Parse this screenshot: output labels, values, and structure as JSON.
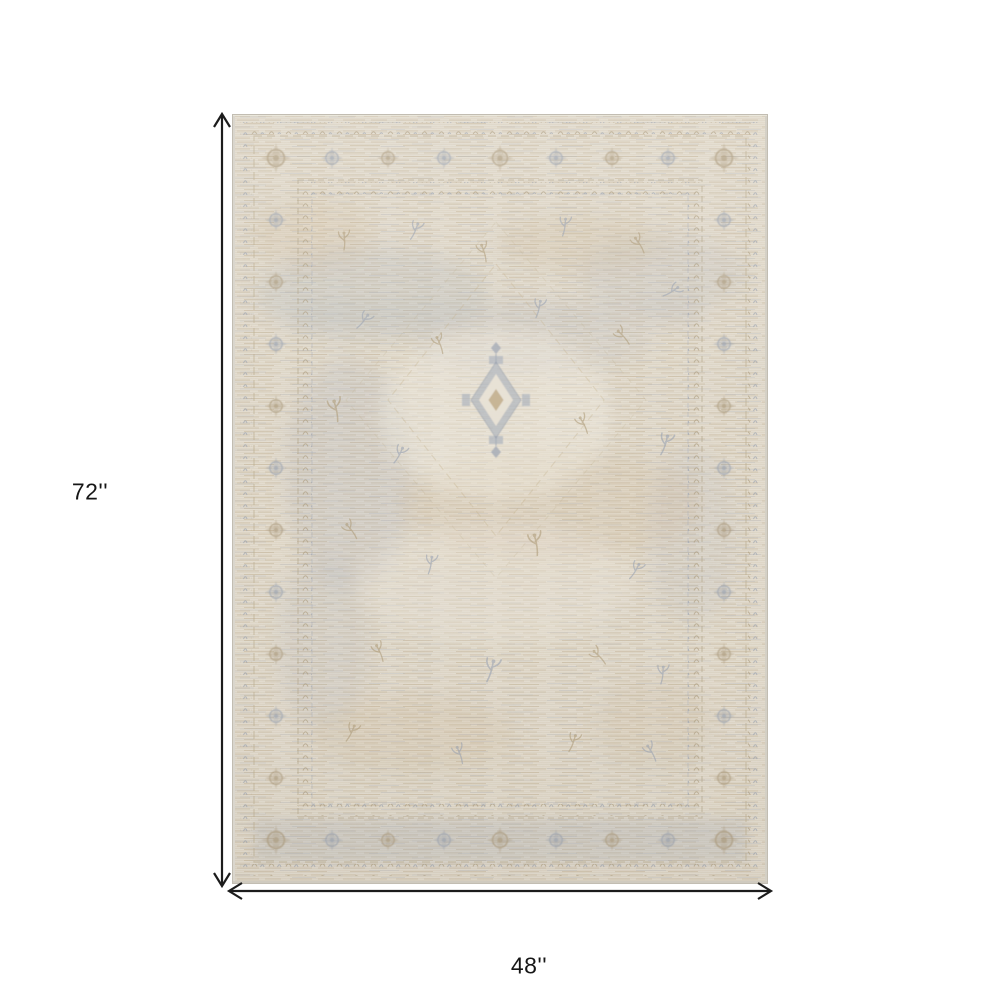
{
  "page": {
    "background": "#ffffff"
  },
  "diagram": {
    "height_label": "72''",
    "width_label": "48''",
    "line_color": "#1c1c1c"
  },
  "rug": {
    "colors": {
      "base": "#e6dfd1",
      "tan": "#c5b190",
      "blue_gray": "#a6adba",
      "cream": "#efeadf",
      "edge": "#dad6cd",
      "outline": "#c2bdb2"
    }
  }
}
